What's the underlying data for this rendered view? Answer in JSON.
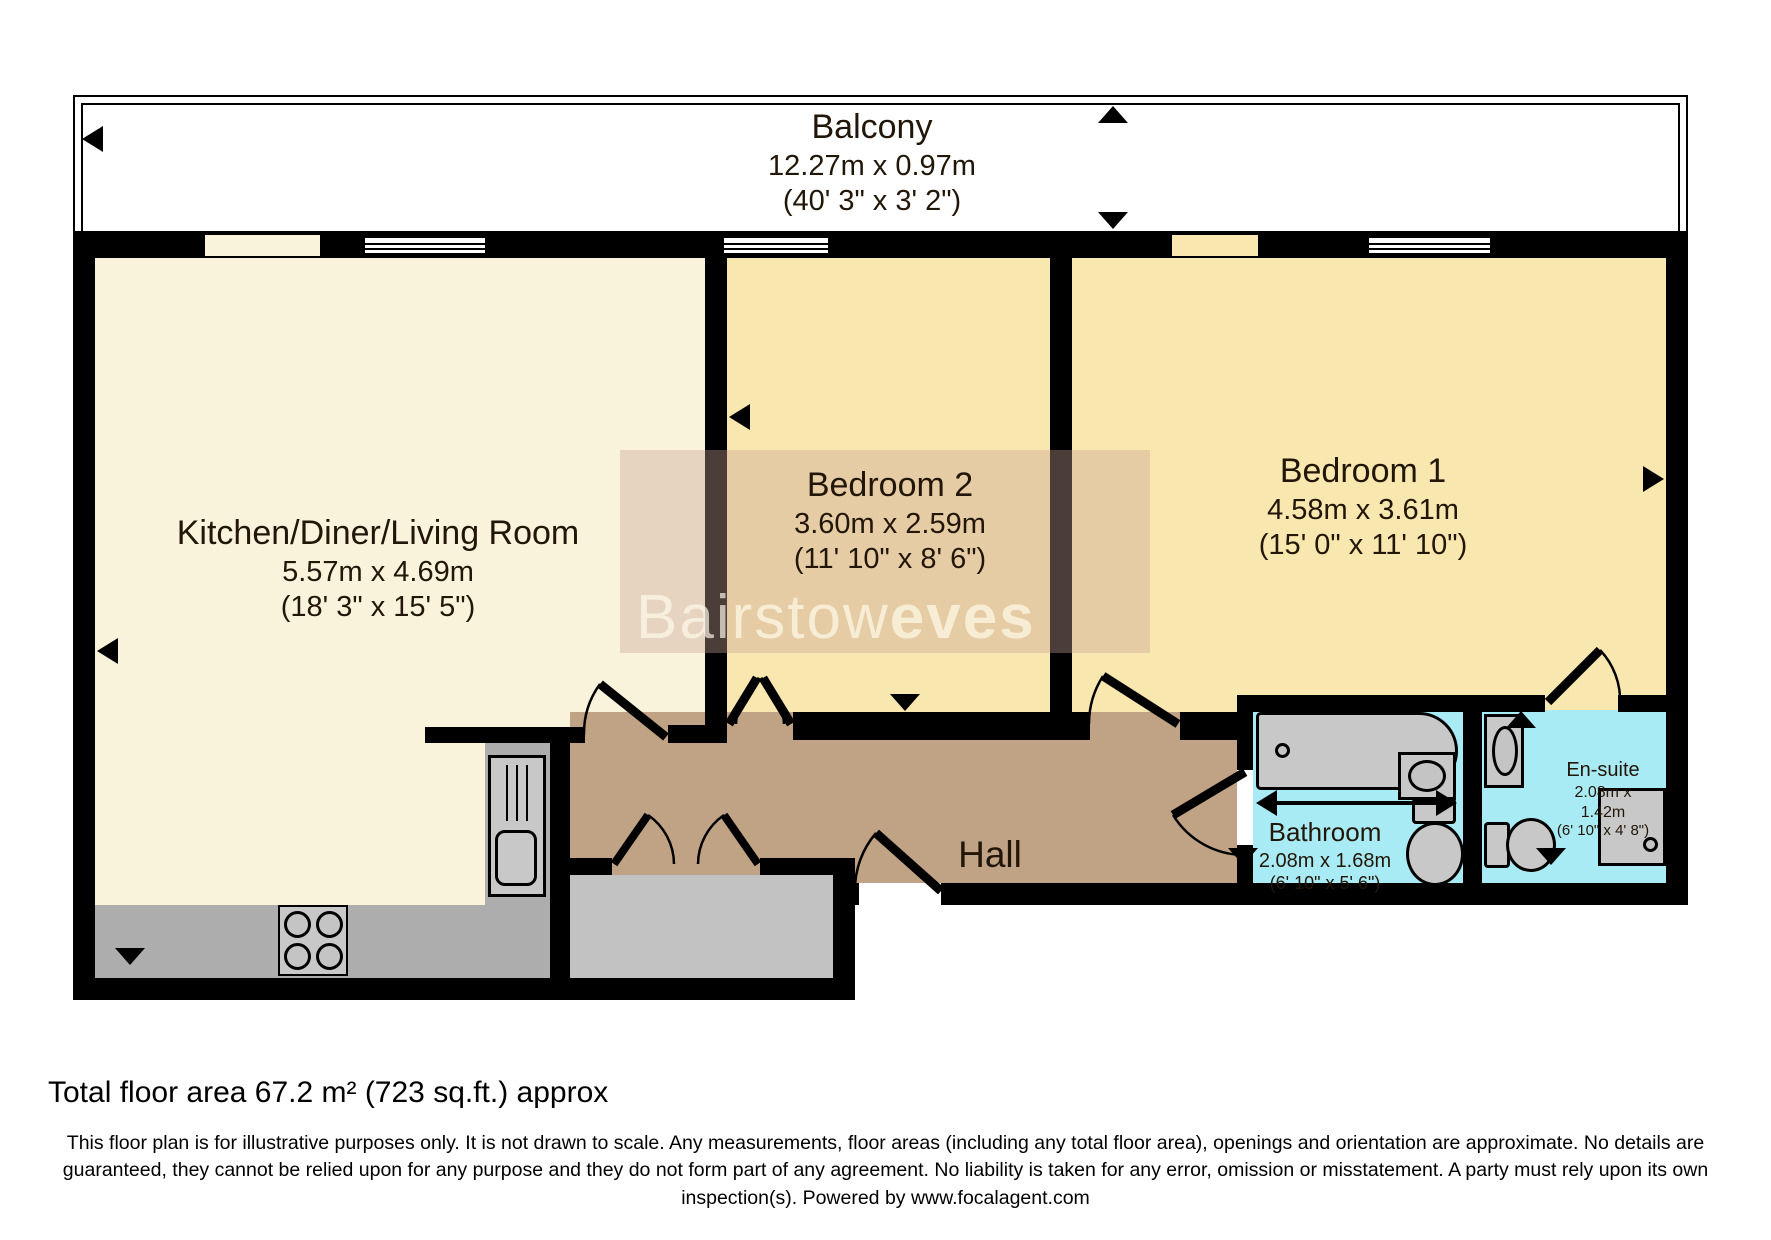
{
  "balcony": {
    "name": "Balcony",
    "metric": "12.27m x 0.97m",
    "imperial": "(40' 3\" x 3' 2\")"
  },
  "rooms": {
    "kitchen": {
      "name": "Kitchen/Diner/Living Room",
      "metric": "5.57m x 4.69m",
      "imperial": "(18' 3\" x 15' 5\")"
    },
    "bedroom2": {
      "name": "Bedroom 2",
      "metric": "3.60m x 2.59m",
      "imperial": "(11' 10\" x 8' 6\")"
    },
    "bedroom1": {
      "name": "Bedroom 1",
      "metric": "4.58m x 3.61m",
      "imperial": "(15' 0\" x 11' 10\")"
    },
    "hall": {
      "name": "Hall"
    },
    "bathroom": {
      "name": "Bathroom",
      "metric": "2.08m x 1.68m",
      "imperial": "(6' 10\" x 5' 6\")"
    },
    "ensuite": {
      "name": "En-suite",
      "metric_line1": "2.08m x",
      "metric_line2": "1.42m",
      "imperial": "(6' 10\" x 4' 8\")"
    }
  },
  "watermark": {
    "part1": "Bairstow",
    "part2": "eves"
  },
  "footer": {
    "total_area": "Total floor area 67.2 m² (723 sq.ft.) approx",
    "disclaimer": "This floor plan is for illustrative purposes only. It is not drawn to scale. Any measurements, floor areas (including any total floor area), openings and orientation are approximate. No details are guaranteed, they cannot be relied upon for any purpose and they do not form part of any agreement. No liability is taken for any error, omission or misstatement. A party must rely upon its own inspection(s). Powered by www.focalagent.com"
  },
  "colors": {
    "kitchen_floor": "#FAF3DB",
    "bedroom_floor": "#F8E7AE",
    "hall_floor": "#C0A384",
    "bath_floor": "#A8EBF5",
    "counter_gray": "#ADADAD",
    "closet_gray": "#C2C2C2",
    "fixture_gray": "#C8C8C8",
    "wall": "#000000"
  }
}
